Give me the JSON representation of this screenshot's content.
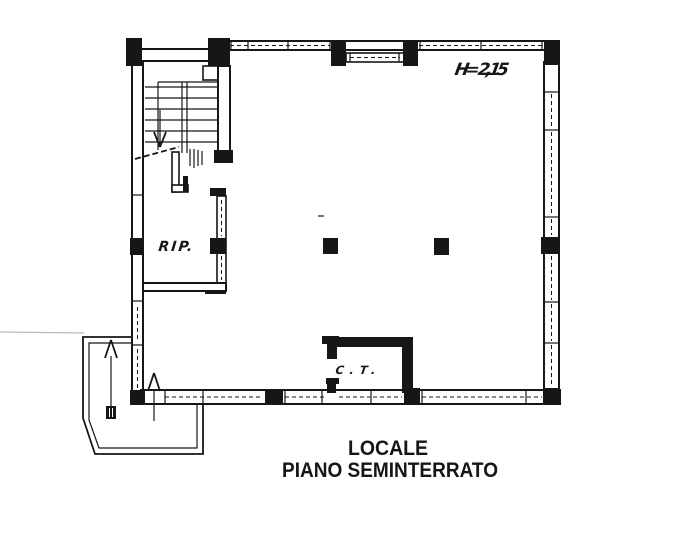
{
  "plan": {
    "annotations": {
      "ceiling_height": "H= 2,15",
      "storage_room": "RIP.",
      "boiler_room": "C.T."
    },
    "caption": {
      "line1": "LOCALE",
      "line2": "PIANO SEMINTERRATO"
    },
    "colors": {
      "ink": "#161616",
      "paper": "#ffffff"
    }
  }
}
